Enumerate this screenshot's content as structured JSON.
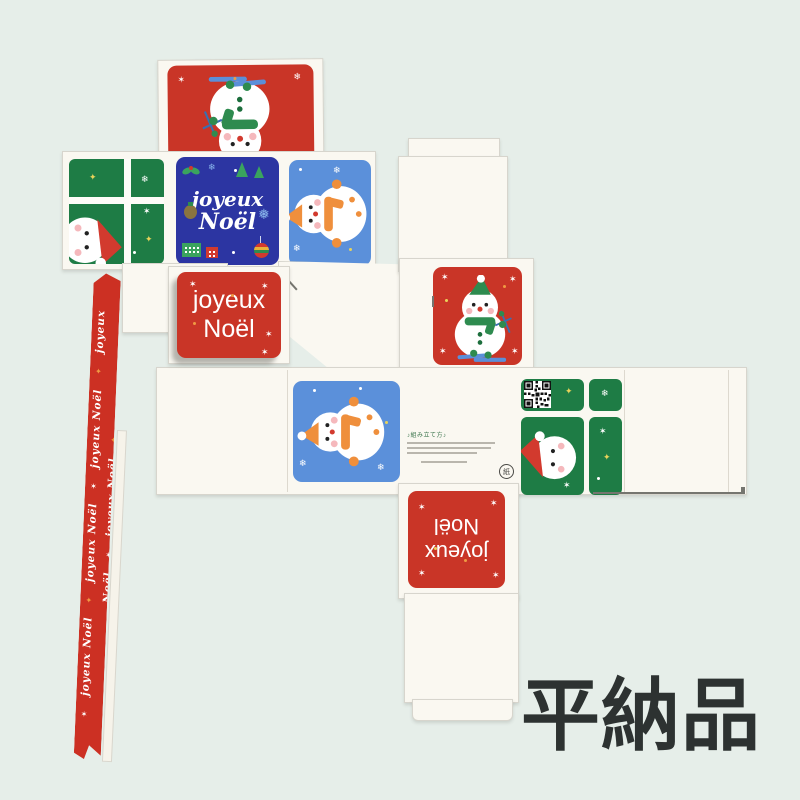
{
  "page": {
    "background": "#e6eee9",
    "flat_pack_label": "平納品"
  },
  "colors": {
    "red": "#c93527",
    "ribbon_red": "#cc3023",
    "dark_blue": "#2c35a2",
    "light_blue": "#5b90da",
    "green": "#1e7c45",
    "accent_green": "#2e8b4f",
    "orange": "#f09a43",
    "cardboard": "#faf8f1",
    "label_gray": "#2d3231"
  },
  "text": {
    "script": {
      "line1": "joyeux",
      "line2": "Noël"
    },
    "sans": {
      "line1": "joyeux",
      "line2": "Noël"
    },
    "ribbon_phrase": "joyeux Noël",
    "instructions_heading": "組み立て方"
  },
  "ribbon": {
    "repeats": 5
  },
  "icons": {
    "snowflake": "❄",
    "snowflake_heavy": "❅",
    "sparkle": "✶",
    "star": "✦",
    "music_note": "♪",
    "recycle_mark": "紙"
  }
}
